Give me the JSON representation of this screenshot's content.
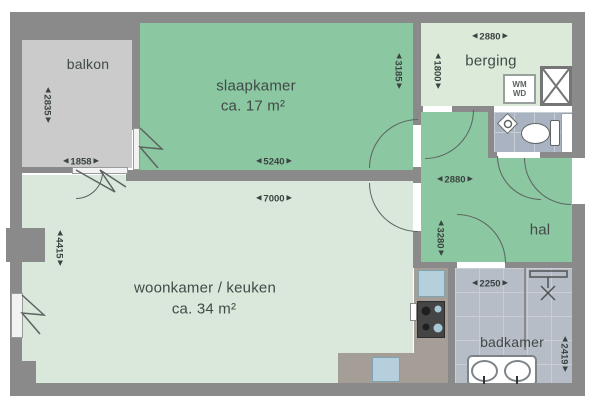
{
  "rooms": {
    "balkon": {
      "label": "balkon"
    },
    "slaapkamer": {
      "label": "slaapkamer",
      "area": "ca. 17 m²"
    },
    "berging": {
      "label": "berging"
    },
    "hal": {
      "label": "hal"
    },
    "woonkamer": {
      "label": "woonkamer / keuken",
      "area": "ca. 34 m²"
    },
    "badkamer": {
      "label": "badkamer"
    }
  },
  "dimensions_mm": {
    "balkon_width": "1858",
    "balkon_depth": "2835",
    "slaapkamer_width": "5240",
    "slaapkamer_depth": "3185",
    "berging_width": "2880",
    "berging_depth": "1800",
    "hal_width": "2880",
    "hal_depth": "3280",
    "woonkamer_width": "7000",
    "woonkamer_depth": "4415",
    "badkamer_width": "2250",
    "badkamer_depth": "2419"
  },
  "appliances": {
    "washer": "WM",
    "dryer": "WD"
  },
  "glyphs": {
    "arrow_left": "◀",
    "arrow_right": "▶"
  },
  "colors": {
    "wall": "#8a8a8a",
    "green_room": "#8bc7a0",
    "pale_room": "#d9e8da",
    "balcony_floor": "#cbcbcb",
    "bathroom_floor": "#b7bdc7",
    "toilet_floor": "#a9b3c2",
    "counter": "#a49e96",
    "fixture_blue": "#b5d0dc",
    "text": "#414a48"
  }
}
